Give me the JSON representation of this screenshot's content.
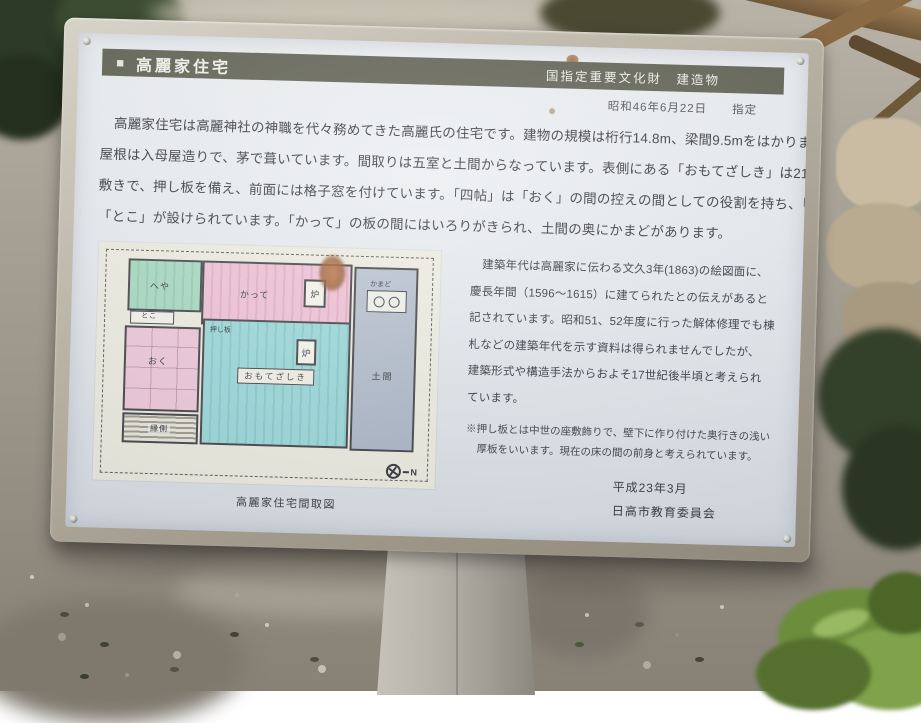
{
  "sign": {
    "band": {
      "bullet": "■",
      "title": "高麗家住宅",
      "designation": "国指定重要文化財　建造物"
    },
    "designated_date": "昭和46年6月22日　　指定",
    "intro_lines": [
      "高麗家住宅は高麗神社の神職を代々務めてきた高麗氏の住宅です。建物の規模は桁行14.8m、梁間9.5mをはかります。",
      "屋根は入母屋造りで、茅で葺いています。間取りは五室と土間からなっています。表側にある「おもてざしき」は21畳の板",
      "敷きで、押し板を備え、前面には格子窓を付けています。「四帖」は「おく」の間の控えの間としての役割を持ち、「おく」には",
      "「とこ」が設けられています。「かって」の板の間にはいろりがきられ、土間の奥にかまどがあります。"
    ],
    "history_lines": [
      "建築年代は高麗家に伝わる文久3年(1863)の絵図面に、",
      "慶長年間（1596〜1615）に建てられたとの伝えがあると",
      "記されています。昭和51、52年度に行った解体修理でも棟",
      "札などの建築年代を示す資料は得られませんでしたが、",
      "建築形式や構造手法からおよそ17世紀後半頃と考えられ",
      "ています。"
    ],
    "note_lines": [
      "※押し板とは中世の座敷飾りで、壁下に作り付けた奥行きの浅い",
      "厚板をいいます。現在の床の間の前身と考えられています。"
    ],
    "credit": {
      "date": "平成23年3月",
      "org": "日高市教育委員会"
    },
    "floorplan": {
      "caption": "高麗家住宅間取図",
      "compass": "N",
      "rooms": {
        "heya": {
          "label": "へや",
          "color": "#9fd6ba"
        },
        "toko": {
          "label": "とこ",
          "color": "#f4f2e8"
        },
        "katte": {
          "label": "かって",
          "color": "#efbcd0"
        },
        "kamado": {
          "label": "かまど"
        },
        "oku": {
          "label": "おく",
          "color": "#eec3d4"
        },
        "engawa": {
          "label": "縁側",
          "color": "#d8d5c8"
        },
        "oshiita": {
          "label": "押し板"
        },
        "omotezashiki": {
          "label": "おもてざしき",
          "color": "#92d5d5"
        },
        "doma": {
          "label": "土間",
          "color": "#aab6c6"
        },
        "hearth1": {
          "label": "炉"
        },
        "hearth2": {
          "label": "炉"
        }
      }
    },
    "colors": {
      "band": "#4e4e3d",
      "face": "#e8ebee",
      "frame": "#b3ac9e"
    }
  }
}
